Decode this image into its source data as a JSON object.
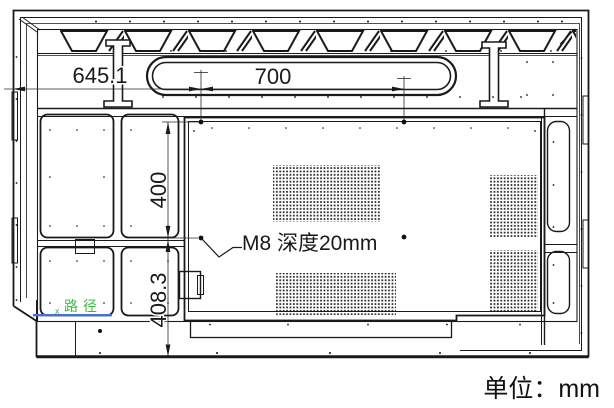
{
  "texts": {
    "dim_left_width": "645.1",
    "dim_handle_spacing": "700",
    "dim_vesa_vertical": "400",
    "dim_lower_height": "408.3",
    "mount_note": "M8 深度20mm",
    "unit_label": "单位：mm",
    "cad_tag": "路径",
    "cad_tag_marker": "x"
  },
  "colors": {
    "line": "#1a1a1a",
    "dim": "#2a2a2a",
    "cad_green": "#3dbb3d",
    "cad_blue": "#4a6fd4"
  }
}
